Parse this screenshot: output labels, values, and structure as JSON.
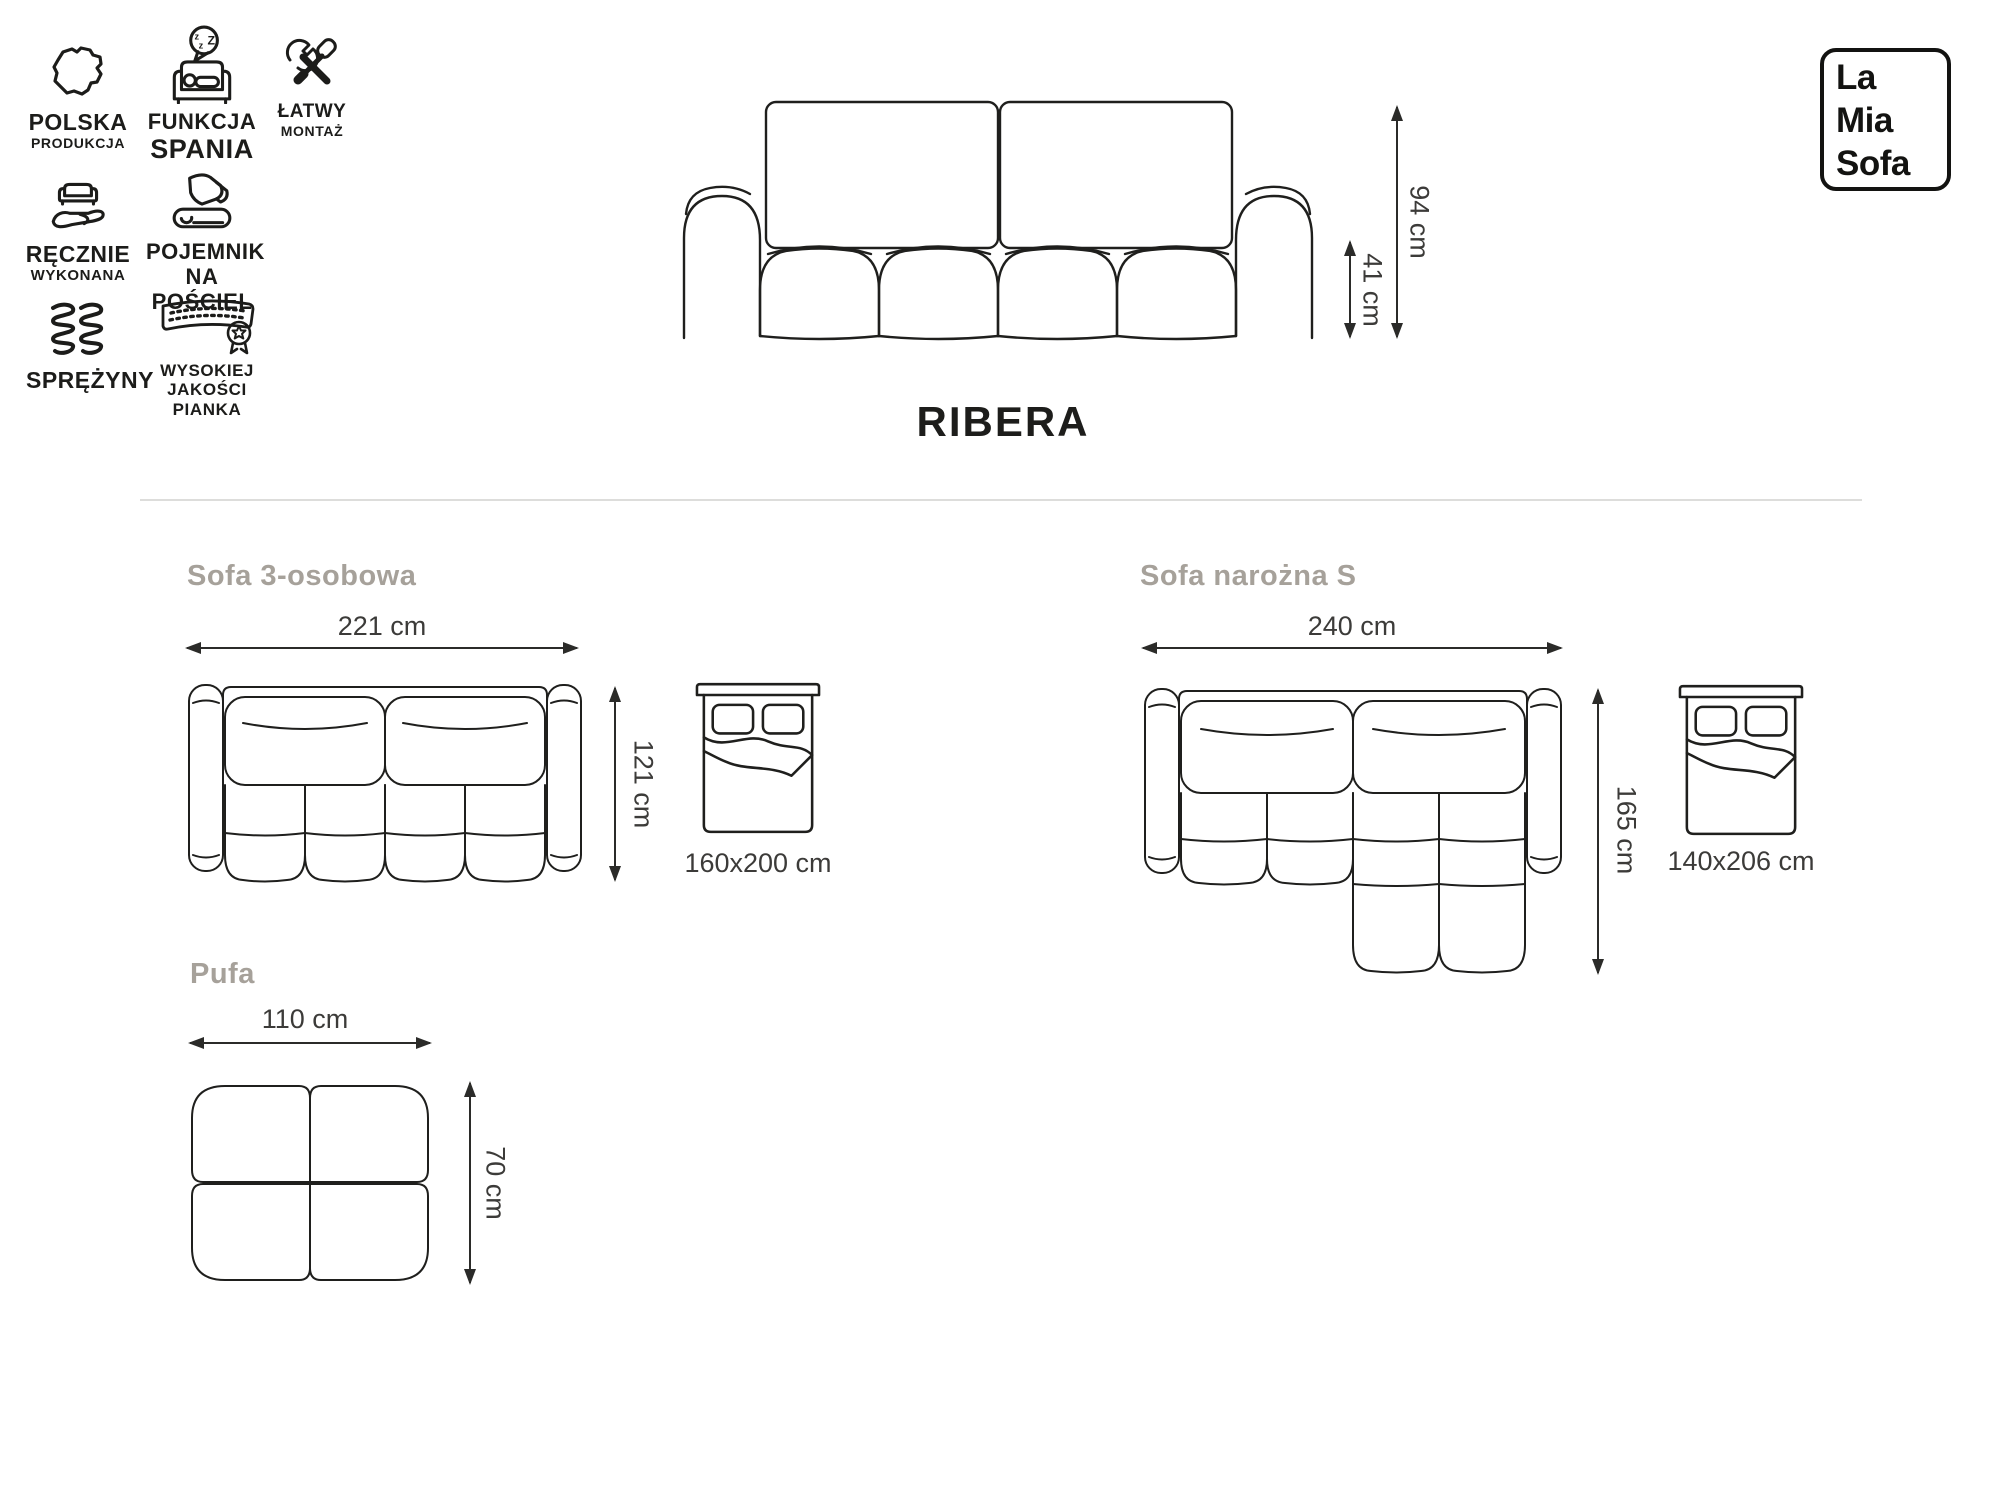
{
  "brand": {
    "line1": "La",
    "line2": "Mia",
    "line3": "Sofa"
  },
  "product": {
    "name": "RIBERA",
    "total_height": "94 cm",
    "seat_height": "41 cm"
  },
  "features": [
    {
      "title": "POLSKA",
      "subtitle": "PRODUKCJA",
      "icon": "poland-map-icon"
    },
    {
      "title": "FUNKCJA",
      "subtitle": "SPANIA",
      "icon": "sleep-function-icon"
    },
    {
      "title": "ŁATWY",
      "subtitle": "MONTAŻ",
      "icon": "easy-assembly-tools-icon"
    },
    {
      "title": "RĘCZNIE",
      "subtitle": "WYKONANA",
      "icon": "handmade-icon"
    },
    {
      "title": "POJEMNIK",
      "subtitle": "NA POŚCIEL",
      "icon": "bedding-storage-icon"
    },
    {
      "title": "SPRĘŻYNY",
      "subtitle": "",
      "icon": "springs-icon"
    },
    {
      "title": "WYSOKIEJ",
      "subtitle": "JAKOŚCI PIANKA",
      "icon": "high-quality-foam-icon"
    }
  ],
  "icons": {
    "zzz": [
      "z",
      "z",
      "Z"
    ]
  },
  "variants": {
    "sofa3": {
      "title": "Sofa 3-osobowa",
      "width": "221 cm",
      "depth": "121 cm",
      "bed": "160x200 cm"
    },
    "corner": {
      "title": "Sofa narożna S",
      "width": "240 cm",
      "depth": "165 cm",
      "bed": "140x206 cm"
    },
    "pouf": {
      "title": "Pufa",
      "width": "110 cm",
      "height": "70 cm"
    }
  },
  "colors": {
    "line": "#1f1f1d",
    "dimension_text": "#3c3b39",
    "section_heading": "#a6a19a",
    "divider": "#dddddb"
  }
}
